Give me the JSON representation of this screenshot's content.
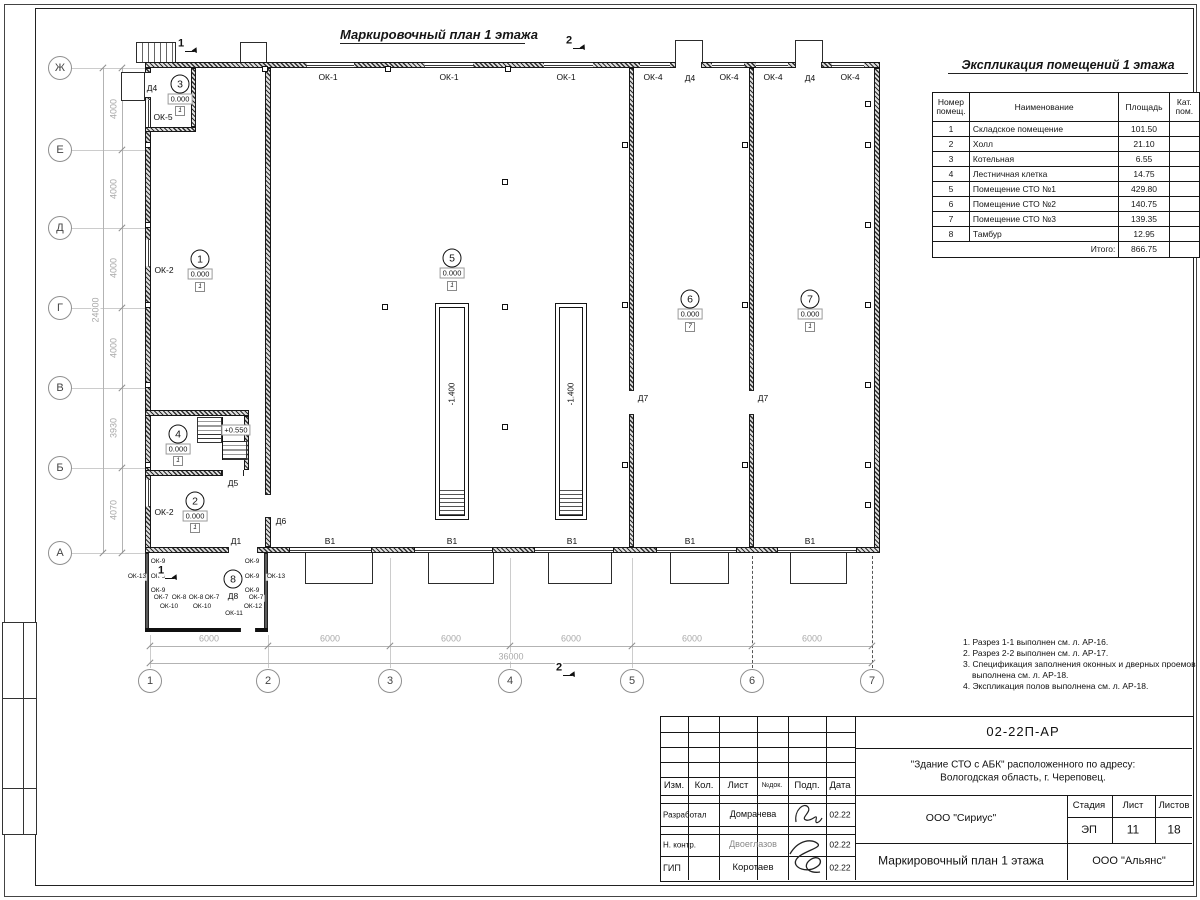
{
  "plan": {
    "title": "Маркировочный план 1 этажа",
    "axes": {
      "rows": [
        {
          "label": "Ж",
          "y": 68
        },
        {
          "label": "Е",
          "y": 150
        },
        {
          "label": "Д",
          "y": 228
        },
        {
          "label": "Г",
          "y": 308
        },
        {
          "label": "В",
          "y": 388
        },
        {
          "label": "Б",
          "y": 468
        },
        {
          "label": "А",
          "y": 553
        }
      ],
      "cols": [
        {
          "label": "1",
          "x": 150
        },
        {
          "label": "2",
          "x": 268
        },
        {
          "label": "3",
          "x": 390
        },
        {
          "label": "4",
          "x": 510
        },
        {
          "label": "5",
          "x": 632
        },
        {
          "label": "6",
          "x": 752
        },
        {
          "label": "7",
          "x": 872
        }
      ]
    },
    "dims": {
      "left_segments": [
        {
          "text": "4000",
          "y": 109
        },
        {
          "text": "4000",
          "y": 189
        },
        {
          "text": "4000",
          "y": 268
        },
        {
          "text": "4000",
          "y": 348
        },
        {
          "text": "3930",
          "y": 428
        },
        {
          "text": "4070",
          "y": 510
        }
      ],
      "left_total": {
        "text": "24000",
        "y": 310
      },
      "bottom_segments": [
        {
          "text": "6000",
          "x": 209
        },
        {
          "text": "6000",
          "x": 330
        },
        {
          "text": "6000",
          "x": 451
        },
        {
          "text": "6000",
          "x": 571
        },
        {
          "text": "6000",
          "x": 692
        },
        {
          "text": "6000",
          "x": 812
        }
      ],
      "bottom_total": {
        "text": "36000",
        "x": 511
      }
    },
    "walls": [
      {
        "x": 145,
        "y": 62,
        "w": 735,
        "h": 6,
        "t": "w"
      },
      {
        "x": 145,
        "y": 68,
        "w": 6,
        "h": 485,
        "t": "w"
      },
      {
        "x": 874,
        "y": 68,
        "w": 6,
        "h": 485,
        "t": "w"
      },
      {
        "x": 145,
        "y": 547,
        "w": 145,
        "h": 6,
        "t": "w"
      },
      {
        "x": 371,
        "y": 547,
        "w": 44,
        "h": 6,
        "t": "w"
      },
      {
        "x": 492,
        "y": 547,
        "w": 43,
        "h": 6,
        "t": "w"
      },
      {
        "x": 613,
        "y": 547,
        "w": 44,
        "h": 6,
        "t": "w"
      },
      {
        "x": 736,
        "y": 547,
        "w": 42,
        "h": 6,
        "t": "w"
      },
      {
        "x": 856,
        "y": 547,
        "w": 24,
        "h": 6,
        "t": "w"
      },
      {
        "x": 265,
        "y": 68,
        "w": 6,
        "h": 479,
        "t": "w"
      },
      {
        "x": 629,
        "y": 68,
        "w": 5,
        "h": 479,
        "t": "w"
      },
      {
        "x": 749,
        "y": 68,
        "w": 5,
        "h": 479,
        "t": "w"
      },
      {
        "x": 145,
        "y": 127,
        "w": 51,
        "h": 5,
        "t": "w"
      },
      {
        "x": 191,
        "y": 68,
        "w": 5,
        "h": 59,
        "t": "w"
      },
      {
        "x": 145,
        "y": 410,
        "w": 104,
        "h": 6,
        "t": "w"
      },
      {
        "x": 244,
        "y": 416,
        "w": 5,
        "h": 54,
        "t": "w"
      },
      {
        "x": 145,
        "y": 470,
        "w": 77,
        "h": 6,
        "t": "w"
      },
      {
        "x": 145,
        "y": 553,
        "w": 4,
        "h": 79,
        "t": "th"
      },
      {
        "x": 264,
        "y": 553,
        "w": 4,
        "h": 79,
        "t": "th"
      },
      {
        "x": 145,
        "y": 628,
        "w": 123,
        "h": 4,
        "t": "k"
      }
    ],
    "openings": [
      {
        "x": 307,
        "y": 62,
        "w": 47,
        "h": 6,
        "t": "wh"
      },
      {
        "x": 425,
        "y": 62,
        "w": 48,
        "h": 6,
        "t": "wh"
      },
      {
        "x": 544,
        "y": 62,
        "w": 49,
        "h": 6,
        "t": "wh"
      },
      {
        "x": 640,
        "y": 62,
        "w": 30,
        "h": 6,
        "t": "wh"
      },
      {
        "x": 712,
        "y": 62,
        "w": 32,
        "h": 6,
        "t": "wh"
      },
      {
        "x": 756,
        "y": 62,
        "w": 32,
        "h": 6,
        "t": "wh"
      },
      {
        "x": 832,
        "y": 62,
        "w": 32,
        "h": 6,
        "t": "wh"
      },
      {
        "x": 675,
        "y": 62,
        "w": 27,
        "h": 6,
        "t": "dh"
      },
      {
        "x": 795,
        "y": 62,
        "w": 27,
        "h": 6,
        "t": "dh"
      },
      {
        "x": 145,
        "y": 72,
        "w": 6,
        "h": 26,
        "t": "dv"
      },
      {
        "x": 145,
        "y": 100,
        "w": 6,
        "h": 27,
        "t": "wv"
      },
      {
        "x": 145,
        "y": 240,
        "w": 6,
        "h": 26,
        "t": "wv"
      },
      {
        "x": 145,
        "y": 480,
        "w": 6,
        "h": 26,
        "t": "wv"
      },
      {
        "x": 290,
        "y": 547,
        "w": 81,
        "h": 6,
        "t": "wh"
      },
      {
        "x": 415,
        "y": 547,
        "w": 77,
        "h": 6,
        "t": "wh"
      },
      {
        "x": 535,
        "y": 547,
        "w": 78,
        "h": 6,
        "t": "wh"
      },
      {
        "x": 657,
        "y": 547,
        "w": 79,
        "h": 6,
        "t": "wh"
      },
      {
        "x": 778,
        "y": 547,
        "w": 78,
        "h": 6,
        "t": "wh"
      },
      {
        "x": 228,
        "y": 547,
        "w": 30,
        "h": 6,
        "t": "dh"
      },
      {
        "x": 265,
        "y": 494,
        "w": 6,
        "h": 24,
        "t": "dv"
      },
      {
        "x": 629,
        "y": 390,
        "w": 5,
        "h": 25,
        "t": "dv"
      },
      {
        "x": 749,
        "y": 390,
        "w": 5,
        "h": 25,
        "t": "dv"
      },
      {
        "x": 222,
        "y": 470,
        "w": 22,
        "h": 6,
        "t": "dh"
      },
      {
        "x": 240,
        "y": 628,
        "w": 16,
        "h": 4,
        "t": "dh"
      }
    ],
    "labels": [
      {
        "t": "ОК-1",
        "x": 328,
        "y": 77
      },
      {
        "t": "ОК-1",
        "x": 449,
        "y": 77
      },
      {
        "t": "ОК-1",
        "x": 566,
        "y": 77
      },
      {
        "t": "ОК-4",
        "x": 653,
        "y": 77
      },
      {
        "t": "ОК-4",
        "x": 729,
        "y": 77
      },
      {
        "t": "ОК-4",
        "x": 773,
        "y": 77
      },
      {
        "t": "ОК-4",
        "x": 850,
        "y": 77
      },
      {
        "t": "Д4",
        "x": 690,
        "y": 78
      },
      {
        "t": "Д4",
        "x": 810,
        "y": 78
      },
      {
        "t": "Д4",
        "x": 152,
        "y": 88
      },
      {
        "t": "ОК-5",
        "x": 163,
        "y": 117
      },
      {
        "t": "ОК-2",
        "x": 164,
        "y": 270
      },
      {
        "t": "ОК-2",
        "x": 164,
        "y": 512
      },
      {
        "t": "Д5",
        "x": 233,
        "y": 483
      },
      {
        "t": "Д6",
        "x": 281,
        "y": 521
      },
      {
        "t": "Д1",
        "x": 236,
        "y": 541
      },
      {
        "t": "Д7",
        "x": 643,
        "y": 398
      },
      {
        "t": "Д7",
        "x": 763,
        "y": 398
      },
      {
        "t": "Д8",
        "x": 233,
        "y": 596
      },
      {
        "t": "В1",
        "x": 330,
        "y": 541
      },
      {
        "t": "В1",
        "x": 452,
        "y": 541
      },
      {
        "t": "В1",
        "x": 572,
        "y": 541
      },
      {
        "t": "В1",
        "x": 690,
        "y": 541
      },
      {
        "t": "В1",
        "x": 810,
        "y": 541
      },
      {
        "t": "ОК-9",
        "x": 158,
        "y": 562,
        "s": 1
      },
      {
        "t": "ОК-9",
        "x": 158,
        "y": 577,
        "s": 1
      },
      {
        "t": "ОК-9",
        "x": 158,
        "y": 591,
        "s": 1
      },
      {
        "t": "ОК-9",
        "x": 252,
        "y": 562,
        "s": 1
      },
      {
        "t": "ОК-9",
        "x": 252,
        "y": 577,
        "s": 1
      },
      {
        "t": "ОК-9",
        "x": 252,
        "y": 591,
        "s": 1
      },
      {
        "t": "ОК-13",
        "x": 137,
        "y": 577,
        "s": 1
      },
      {
        "t": "ОК-13",
        "x": 276,
        "y": 577,
        "s": 1
      },
      {
        "t": "ОК-7",
        "x": 161,
        "y": 598,
        "s": 1
      },
      {
        "t": "ОК-8",
        "x": 179,
        "y": 598,
        "s": 1
      },
      {
        "t": "ОК-8",
        "x": 196,
        "y": 598,
        "s": 1
      },
      {
        "t": "ОК-7",
        "x": 212,
        "y": 598,
        "s": 1
      },
      {
        "t": "ОК-7",
        "x": 256,
        "y": 598,
        "s": 1
      },
      {
        "t": "ОК-10",
        "x": 169,
        "y": 607,
        "s": 1
      },
      {
        "t": "ОК-10",
        "x": 202,
        "y": 607,
        "s": 1
      },
      {
        "t": "ОК-12",
        "x": 253,
        "y": 607,
        "s": 1
      },
      {
        "t": "ОК-11",
        "x": 234,
        "y": 614,
        "s": 1
      }
    ],
    "rooms": [
      {
        "num": "3",
        "cx": 180,
        "cy": 84,
        "elev": "0.000",
        "ey": 99,
        "floor": "1",
        "fy": 111
      },
      {
        "num": "1",
        "cx": 200,
        "cy": 259,
        "elev": "0.000",
        "ey": 274,
        "floor": "1",
        "fy": 287
      },
      {
        "num": "5",
        "cx": 452,
        "cy": 258,
        "elev": "0.000",
        "ey": 273,
        "floor": "1",
        "fy": 286
      },
      {
        "num": "6",
        "cx": 690,
        "cy": 299,
        "elev": "0.000",
        "ey": 314,
        "floor": "7",
        "fy": 327
      },
      {
        "num": "7",
        "cx": 810,
        "cy": 299,
        "elev": "0.000",
        "ey": 314,
        "floor": "1",
        "fy": 327
      },
      {
        "num": "4",
        "cx": 178,
        "cy": 434,
        "elev": "0.000",
        "ey": 449,
        "floor": "1",
        "fy": 461
      },
      {
        "num": "2",
        "cx": 195,
        "cy": 501,
        "elev": "0.000",
        "ey": 516,
        "floor": "1",
        "fy": 528
      },
      {
        "num": "8",
        "cx": 233,
        "cy": 579
      }
    ],
    "landing_elev": {
      "text": "+0.550",
      "x": 236,
      "y": 430
    },
    "pits": [
      {
        "x": 435,
        "y": 303,
        "w": 32,
        "h": 215,
        "label": "-1.400"
      },
      {
        "x": 555,
        "y": 303,
        "w": 30,
        "h": 215,
        "label": "-1.400"
      }
    ],
    "ramps": [
      {
        "x": 305,
        "y": 553,
        "w": 66,
        "h": 30
      },
      {
        "x": 428,
        "y": 553,
        "w": 64,
        "h": 30
      },
      {
        "x": 548,
        "y": 553,
        "w": 62,
        "h": 30
      },
      {
        "x": 670,
        "y": 553,
        "w": 57,
        "h": 30
      },
      {
        "x": 790,
        "y": 553,
        "w": 55,
        "h": 30
      }
    ],
    "porches": [
      {
        "x": 136,
        "y": 42,
        "w": 40,
        "h": 21,
        "steps": 1
      },
      {
        "x": 240,
        "y": 42,
        "w": 27,
        "h": 21
      },
      {
        "x": 675,
        "y": 40,
        "w": 28,
        "h": 23
      },
      {
        "x": 795,
        "y": 40,
        "w": 28,
        "h": 23
      },
      {
        "x": 121,
        "y": 72,
        "w": 24,
        "h": 29
      }
    ],
    "stairs": [
      {
        "x": 197,
        "y": 417,
        "w": 25,
        "h": 26
      },
      {
        "x": 222,
        "y": 441,
        "w": 25,
        "h": 19
      }
    ],
    "squares": [
      [
        265,
        69
      ],
      [
        388,
        69
      ],
      [
        508,
        69
      ],
      [
        148,
        145
      ],
      [
        148,
        225
      ],
      [
        148,
        305
      ],
      [
        148,
        385
      ],
      [
        148,
        465
      ],
      [
        868,
        104
      ],
      [
        868,
        145
      ],
      [
        868,
        225
      ],
      [
        868,
        305
      ],
      [
        868,
        385
      ],
      [
        868,
        465
      ],
      [
        868,
        505
      ],
      [
        625,
        145
      ],
      [
        625,
        305
      ],
      [
        625,
        465
      ],
      [
        745,
        145
      ],
      [
        745,
        305
      ],
      [
        745,
        465
      ],
      [
        505,
        182
      ],
      [
        505,
        307
      ],
      [
        505,
        427
      ],
      [
        385,
        307
      ]
    ],
    "dash_lines": [
      {
        "x": 752,
        "y1": 556,
        "y2": 668
      },
      {
        "x": 872,
        "y1": 556,
        "y2": 668
      }
    ],
    "sections": [
      {
        "num": "1",
        "x": 181,
        "y": 44
      },
      {
        "num": "2",
        "x": 569,
        "y": 41
      },
      {
        "num": "1",
        "x": 161,
        "y": 571
      },
      {
        "num": "2",
        "x": 559,
        "y": 668
      }
    ]
  },
  "explication": {
    "title": "Экспликация помещений 1 этажа",
    "headers": [
      "Номер помещ.",
      "Наименование",
      "Площадь",
      "Кат. пом."
    ],
    "rows": [
      [
        "1",
        "Складское помещение",
        "101.50",
        ""
      ],
      [
        "2",
        "Холл",
        "21.10",
        ""
      ],
      [
        "3",
        "Котельная",
        "6.55",
        ""
      ],
      [
        "4",
        "Лестничная клетка",
        "14.75",
        ""
      ],
      [
        "5",
        "Помещение СТО №1",
        "429.80",
        ""
      ],
      [
        "6",
        "Помещение СТО №2",
        "140.75",
        ""
      ],
      [
        "7",
        "Помещение СТО №3",
        "139.35",
        ""
      ],
      [
        "8",
        "Тамбур",
        "12.95",
        ""
      ]
    ],
    "total_label": "Итого:",
    "total_value": "866.75"
  },
  "notes": [
    "1. Разрез 1-1 выполнен см. л. АР-16.",
    "2. Разрез 2-2 выполнен см. л. АР-17.",
    "3. Спецификация заполнения оконных и дверных проемов выполнена см. л. АР-18.",
    "4. Экспликация полов выполнена см. л. АР-18."
  ],
  "titleblock": {
    "doc_number": "02-22П-АР",
    "project_line1": "\"Здание СТО с АБК\" расположенного по адресу:",
    "project_line2": "Вологодская область, г. Череповец.",
    "org": "ООО \"Сириус\"",
    "sheet_title": "Маркировочный план 1 этажа",
    "company": "ООО \"Альянс\"",
    "header_cols": [
      "Изм.",
      "Кол.",
      "Лист",
      "№док.",
      "Подп.",
      "Дата"
    ],
    "stage_label": "Стадия",
    "sheet_label": "Лист",
    "sheets_label": "Листов",
    "stage": "ЭП",
    "sheet_num": "11",
    "sheets_total": "18",
    "rows": [
      {
        "role": "Разработал",
        "name": "Домрачева",
        "date": "02.22"
      },
      {
        "role": "Н. контр.",
        "name": "Двоеглазов",
        "date": "02.22"
      },
      {
        "role": "ГИП",
        "name": "Коротаев",
        "date": "02.22"
      }
    ]
  }
}
